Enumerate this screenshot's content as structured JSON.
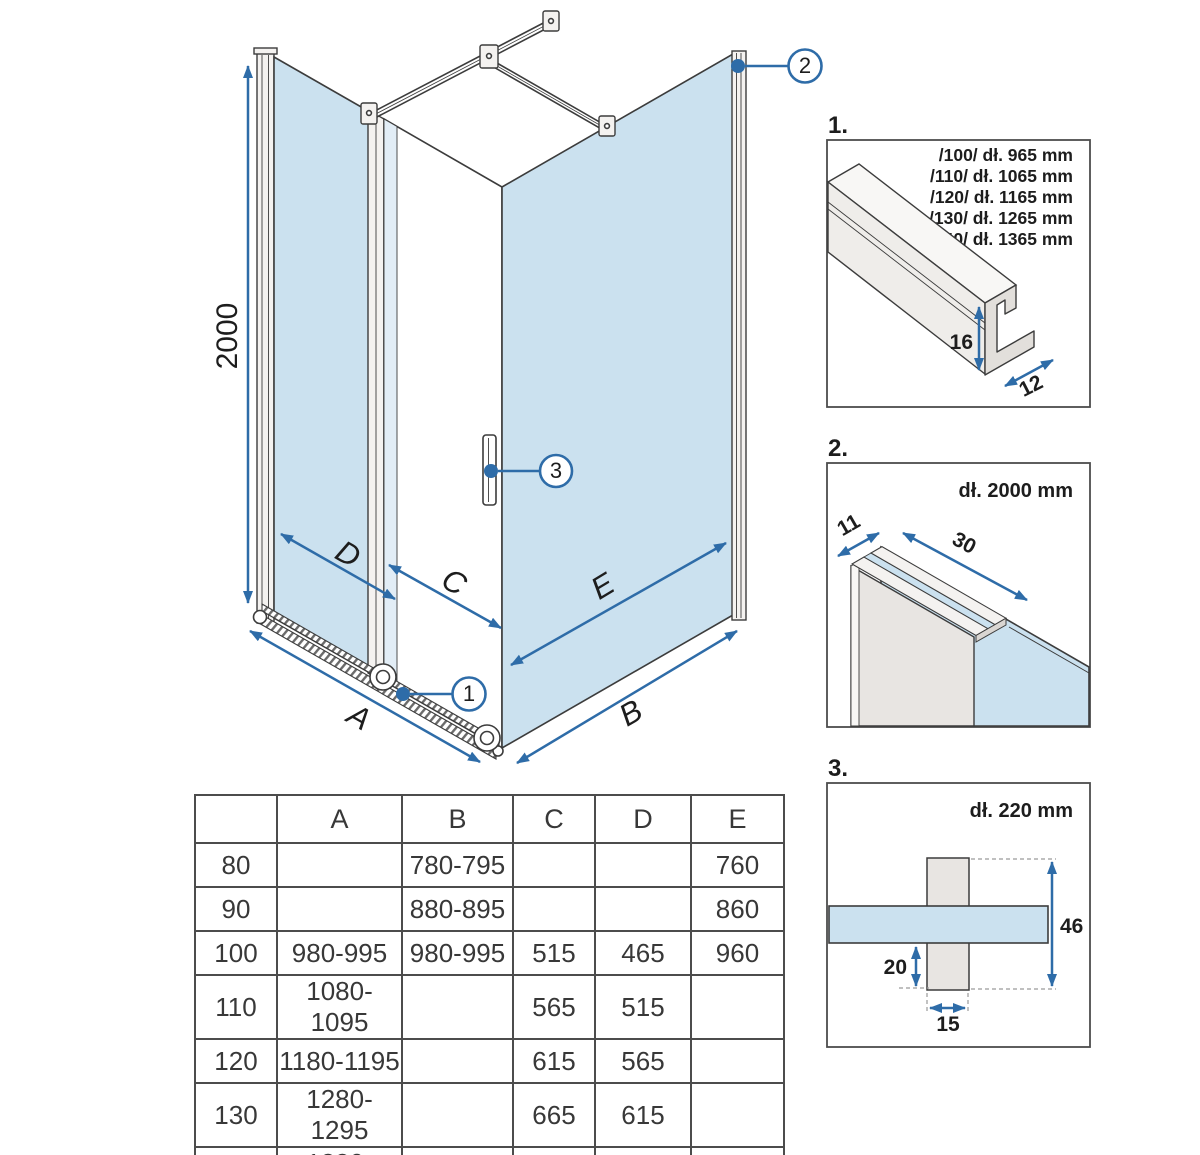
{
  "colors": {
    "glass_blue": "#cbe1ef",
    "accent_blue": "#2e6ca8",
    "line_dark": "#3c3c3c",
    "table_border": "#4c4c4c"
  },
  "diagram": {
    "height_dim": "2000",
    "label_a": "A",
    "label_b": "B",
    "label_c": "C",
    "label_d": "D",
    "label_e": "E",
    "marker_1": "1",
    "marker_2": "2",
    "marker_3": "3"
  },
  "detail1": {
    "label": "1.",
    "lines": [
      "/100/ dł. 965 mm",
      "/110/ dł. 1065 mm",
      "/120/ dł. 1165 mm",
      "/130/ dł. 1265 mm",
      "/140/ dł. 1365 mm"
    ],
    "dim_height": "16",
    "dim_width": "12"
  },
  "detail2": {
    "label": "2.",
    "length": "dł. 2000 mm",
    "dim_depth": "11",
    "dim_width": "30"
  },
  "detail3": {
    "label": "3.",
    "length": "dł. 220 mm",
    "dim_h": "46",
    "dim_off": "20",
    "dim_w": "15"
  },
  "size_table": {
    "headers": [
      "",
      "A",
      "B",
      "C",
      "D",
      "E"
    ],
    "rows": [
      {
        "size": "80",
        "a": "",
        "b": "780-795",
        "c": "",
        "d": "",
        "e": "760"
      },
      {
        "size": "90",
        "a": "",
        "b": "880-895",
        "c": "",
        "d": "",
        "e": "860"
      },
      {
        "size": "100",
        "a": "980-995",
        "b": "980-995",
        "c": "515",
        "d": "465",
        "e": "960"
      },
      {
        "size": "110",
        "a": "1080-1095",
        "b": "",
        "c": "565",
        "d": "515",
        "e": ""
      },
      {
        "size": "120",
        "a": "1180-1195",
        "b": "",
        "c": "615",
        "d": "565",
        "e": ""
      },
      {
        "size": "130",
        "a": "1280-1295",
        "b": "",
        "c": "665",
        "d": "615",
        "e": ""
      },
      {
        "size": "140",
        "a": "1380-1395",
        "b": "",
        "c": "715",
        "d": "665",
        "e": ""
      }
    ]
  }
}
